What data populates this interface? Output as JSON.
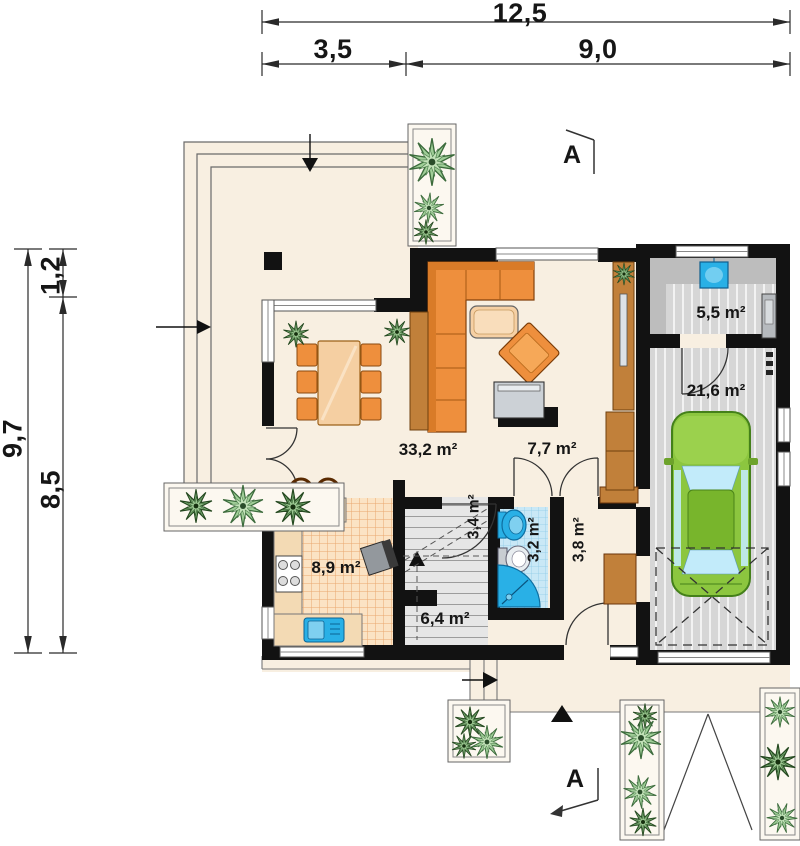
{
  "dimensions": {
    "top_total": "12,5",
    "top_left": "3,5",
    "top_right": "9,0",
    "side_total": "9,7",
    "side_upper": "1,2",
    "side_lower": "8,5"
  },
  "sections": {
    "top": "A",
    "bottom": "A"
  },
  "rooms": {
    "living": {
      "area": "33,2 m²"
    },
    "hall": {
      "area": "7,7 m²"
    },
    "kitchen": {
      "area": "8,9 m²"
    },
    "stairs": {
      "area": "6,4 m²"
    },
    "understairs": {
      "area": "3,4 m²"
    },
    "bathroom": {
      "area": "3,2 m²"
    },
    "corridor": {
      "area": "3,8 m²"
    },
    "utility": {
      "area": "5,5 m²"
    },
    "garage": {
      "area": "21,6 m²"
    }
  },
  "colors": {
    "wall": "#121212",
    "floor": "#f8efe1",
    "kitchen-tile": "#fbe3c4",
    "bathroom-tile": "#c9e8f6",
    "garage-floor": "#d6d6d6",
    "furniture-orange": "#ee8f3d",
    "wood": "#c1803a",
    "car-green": "#8cc63f",
    "plant-green": "#9fce97",
    "fixture-blue": "#29b0e6"
  }
}
